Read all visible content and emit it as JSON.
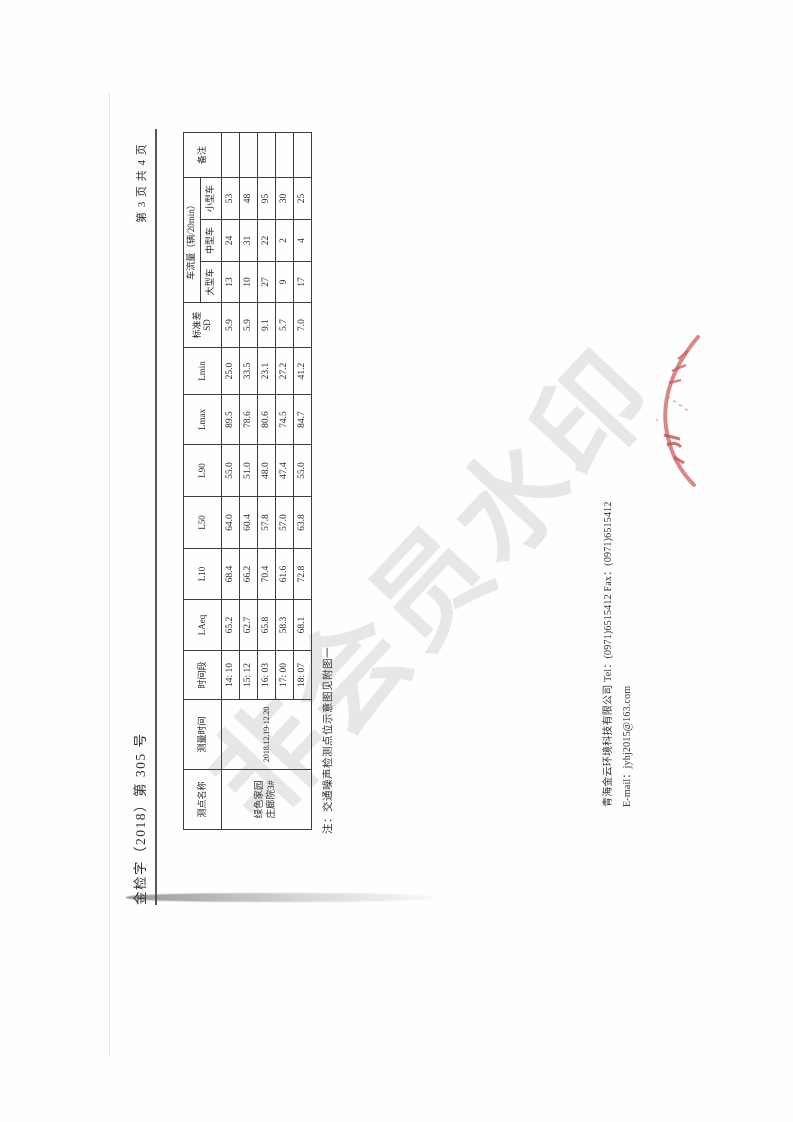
{
  "document": {
    "ref_number": "金检字（2018）第 305 号",
    "page_indicator": "第 3 页 共 4 页",
    "note": "注：交通噪声检测点位示意图见附图一",
    "footer": {
      "line1": "青海金云环境科技有限公司 Tel：(0971)6515412  Fax：(0971)6515412",
      "line2": "E-mail：jyhj2015@163.com"
    },
    "watermark": "非会员水印"
  },
  "table": {
    "header": {
      "point_name": "测点名称",
      "measure_time": "测量时间",
      "time_period": "时间段",
      "laeq": "LAeq",
      "l10": "L10",
      "l50": "L50",
      "l90": "L90",
      "lmax": "Lmax",
      "lmin": "Lmin",
      "sd_line1": "标准差",
      "sd_line2": "SD",
      "traffic_group": "车流量（辆/20min）",
      "vehicle_large": "大型车",
      "vehicle_medium": "中型车",
      "vehicle_small": "小型车",
      "remark": "备注"
    },
    "point_name_line1": "绿色家园",
    "point_name_line2": "庄廊院3#",
    "measure_time_value": "2018.12.19-12.20",
    "rows": [
      {
        "period": "14: 10",
        "laeq": "65.2",
        "l10": "68.4",
        "l50": "64.0",
        "l90": "55.0",
        "lmax": "89.5",
        "lmin": "25.0",
        "sd": "5.9",
        "large": "13",
        "medium": "24",
        "small": "53",
        "remark": ""
      },
      {
        "period": "15: 12",
        "laeq": "62.7",
        "l10": "66.2",
        "l50": "60.4",
        "l90": "51.0",
        "lmax": "78.6",
        "lmin": "33.5",
        "sd": "5.9",
        "large": "10",
        "medium": "31",
        "small": "48",
        "remark": ""
      },
      {
        "period": "16: 03",
        "laeq": "65.8",
        "l10": "70.4",
        "l50": "57.8",
        "l90": "48.0",
        "lmax": "80.6",
        "lmin": "23.1",
        "sd": "9.1",
        "large": "27",
        "medium": "22",
        "small": "95",
        "remark": ""
      },
      {
        "period": "17: 00",
        "laeq": "58.3",
        "l10": "61.6",
        "l50": "57.0",
        "l90": "47.4",
        "lmax": "74.5",
        "lmin": "27.2",
        "sd": "5.7",
        "large": "9",
        "medium": "2",
        "small": "30",
        "remark": ""
      },
      {
        "period": "18: 07",
        "laeq": "68.1",
        "l10": "72.8",
        "l50": "63.8",
        "l90": "55.0",
        "lmax": "84.7",
        "lmin": "41.2",
        "sd": "7.0",
        "large": "17",
        "medium": "4",
        "small": "25",
        "remark": ""
      }
    ]
  }
}
